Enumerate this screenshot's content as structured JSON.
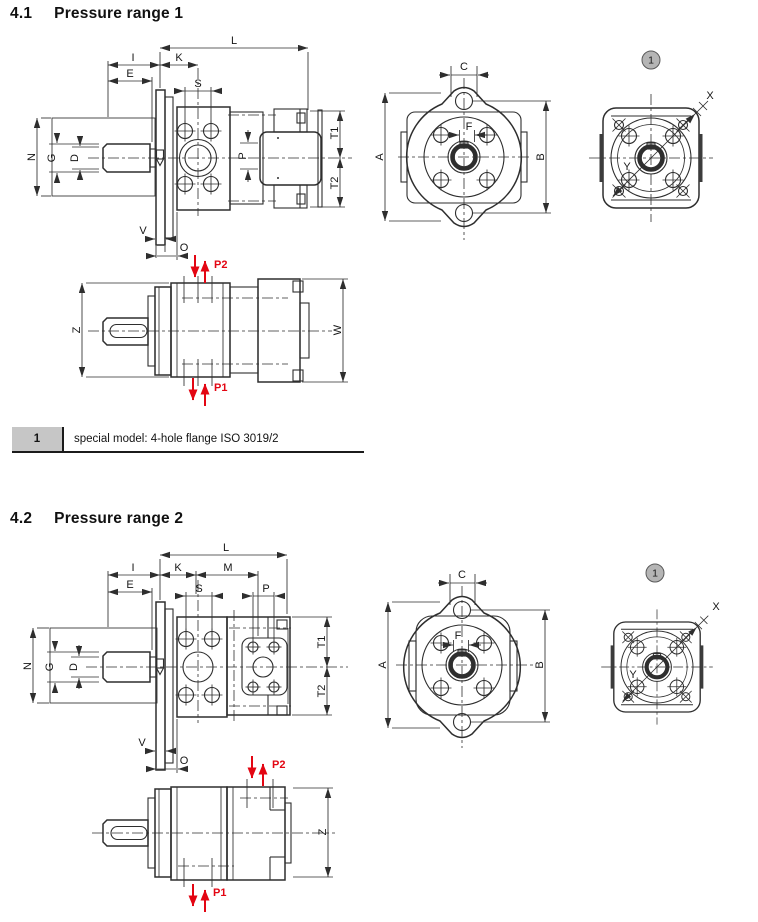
{
  "document": {
    "sections": [
      {
        "number": "4.1",
        "title": "Pressure range 1",
        "callout": "1",
        "legend": {
          "ref": "1",
          "text": "special model: 4-hole flange ISO 3019/2"
        },
        "dims": {
          "L": "L",
          "I": "I",
          "K": "K",
          "E": "E",
          "S": "S",
          "P": "P",
          "N": "N",
          "G": "G",
          "D": "D",
          "T1": "T1",
          "T2": "T2",
          "V": "V",
          "O": "O",
          "A": "A",
          "B": "B",
          "C": "C",
          "F": "F",
          "X": "X",
          "Y": "Y",
          "Z": "Z",
          "W": "W"
        },
        "ports": {
          "p1": "P1",
          "p2": "P2"
        }
      },
      {
        "number": "4.2",
        "title": "Pressure range 2",
        "callout": "1",
        "dims": {
          "L": "L",
          "I": "I",
          "K": "K",
          "M": "M",
          "E": "E",
          "S": "S",
          "P": "P",
          "N": "N",
          "G": "G",
          "D": "D",
          "T1": "T1",
          "T2": "T2",
          "V": "V",
          "O": "O",
          "A": "A",
          "B": "B",
          "C": "C",
          "F": "F",
          "X": "X",
          "Y": "Y",
          "Z": "Z"
        },
        "ports": {
          "p1": "P1",
          "p2": "P2"
        }
      }
    ]
  },
  "colors": {
    "line": "#2e2e2e",
    "dim_text": "#151515",
    "port_red": "#e30613",
    "callout_fill": "#b5b5b5",
    "legend_fill": "#c6c6c6"
  }
}
